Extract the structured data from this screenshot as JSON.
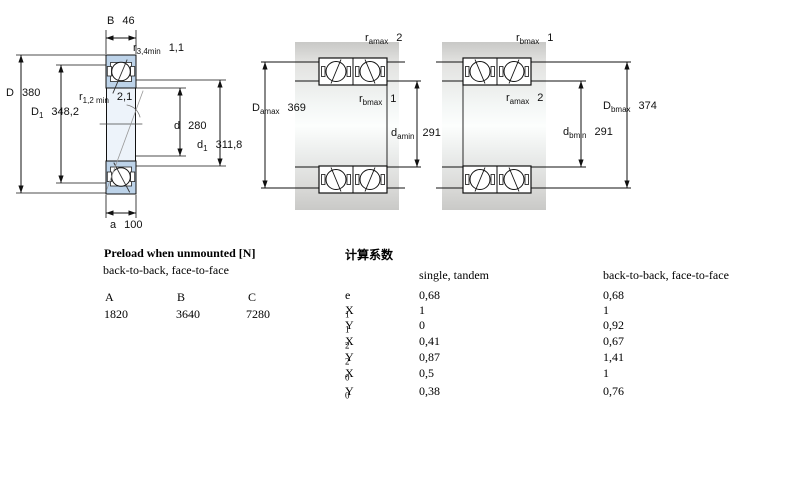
{
  "colors": {
    "bearing_fill": "#bdd3e9",
    "bore_fill": "#edf3fa",
    "line": "#111111"
  },
  "fig1": {
    "dims": {
      "B": {
        "base": "B",
        "sub": "",
        "value": "46"
      },
      "r34": {
        "base": "r",
        "sub": "3,4min",
        "value": "1,1"
      },
      "D": {
        "base": "D",
        "sub": "",
        "value": "380"
      },
      "r12": {
        "base": "r",
        "sub": "1,2 min",
        "value": "2,1"
      },
      "D1": {
        "base": "D",
        "sub": "1",
        "value": "348,2"
      },
      "d": {
        "base": "d",
        "sub": "",
        "value": "280"
      },
      "d1": {
        "base": "d",
        "sub": "1",
        "value": "311,8"
      },
      "a": {
        "base": "a",
        "sub": "",
        "value": "100"
      }
    }
  },
  "fig2": {
    "dims": {
      "ramax": {
        "base": "r",
        "sub": "amax",
        "value": "2"
      },
      "rbmax": {
        "base": "r",
        "sub": "bmax",
        "value": "1"
      },
      "Damax": {
        "base": "D",
        "sub": "amax",
        "value": "369"
      },
      "damin": {
        "base": "d",
        "sub": "amin",
        "value": "291"
      }
    }
  },
  "fig3": {
    "dims": {
      "rbmax": {
        "base": "r",
        "sub": "bmax",
        "value": "1"
      },
      "ramax": {
        "base": "r",
        "sub": "amax",
        "value": "2"
      },
      "Dbmax": {
        "base": "D",
        "sub": "bmax",
        "value": "374"
      },
      "dbmin": {
        "base": "d",
        "sub": "bmin",
        "value": "291"
      }
    }
  },
  "preload": {
    "title": "Preload when unmounted [N]",
    "subtitle": "back-to-back, face-to-face",
    "headers": [
      "A",
      "B",
      "C"
    ],
    "values": [
      "1820",
      "3640",
      "7280"
    ]
  },
  "factors": {
    "title": "计算系数",
    "col1": "single, tandem",
    "col2": "back-to-back, face-to-face",
    "rows": [
      {
        "base": "e",
        "sub": "",
        "v1": "0,68",
        "v2": "0,68"
      },
      {
        "base": "X",
        "sub": "1",
        "v1": "1",
        "v2": "1"
      },
      {
        "base": "Y",
        "sub": "1",
        "v1": "0",
        "v2": "0,92"
      },
      {
        "base": "X",
        "sub": "2",
        "v1": "0,41",
        "v2": "0,67"
      },
      {
        "base": "Y",
        "sub": "2",
        "v1": "0,87",
        "v2": "1,41"
      },
      {
        "base": "X",
        "sub": "0",
        "v1": "0,5",
        "v2": "1"
      },
      {
        "base": "Y",
        "sub": "0",
        "v1": "0,38",
        "v2": "0,76"
      }
    ]
  }
}
